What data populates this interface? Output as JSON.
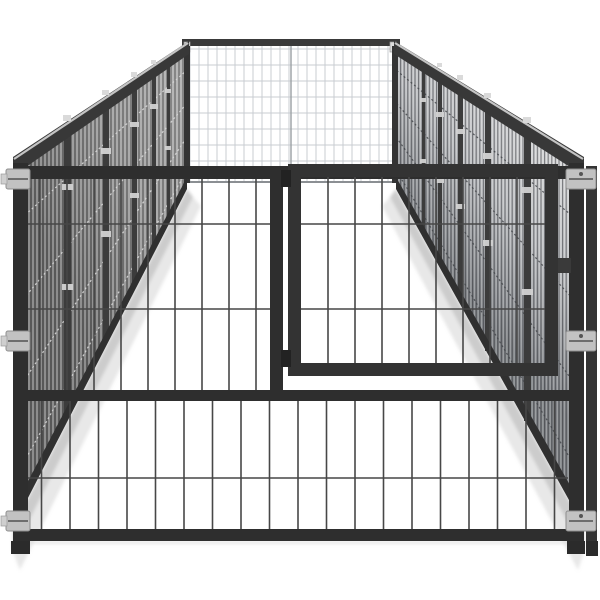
{
  "image": {
    "aria_label": "Black steel outdoor dog kennel with wire mesh panels and a front gate, shown in perspective on a white background",
    "product": "outdoor dog kennel",
    "colors": {
      "background": "#ffffff",
      "frame": "#2e2e2e",
      "gate_frame": "#333333",
      "front_wire": "#474747",
      "left_wall_dark": "#686868",
      "left_wall_light": "#a2a2a2",
      "right_wall_light": "#e2e2e2",
      "right_wall_dark": "#7e8185",
      "back_mesh": "#c9ccd2",
      "rail_highlight": "#c4c4c4",
      "clamp": "#c2c2c2",
      "shadow": "#9a9a9a"
    }
  }
}
